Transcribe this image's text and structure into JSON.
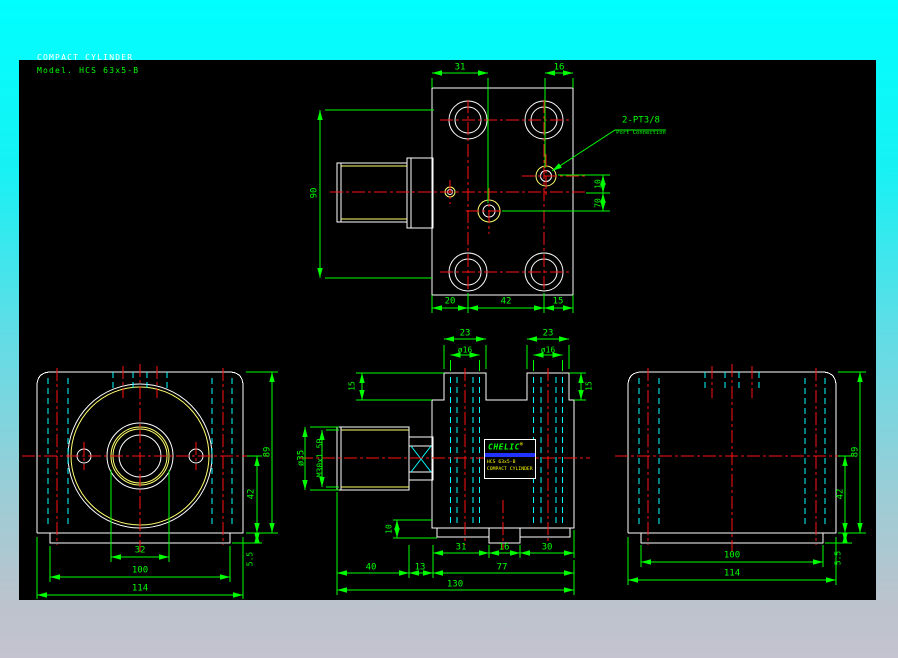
{
  "palette": {
    "background_top": "#00ffff",
    "background_bottom": "#c4c3cf",
    "canvas": "#000000",
    "outline": "#ffffff",
    "dimension": "#00ff00",
    "centerline": "#ff1212",
    "hidden": "#00ffff",
    "thread": "#ffff6e",
    "label_bar": "#2233ff",
    "label_text": "#ffff00"
  },
  "title": {
    "line1": "COMPACT CYLINDER",
    "line2": "Model. HCS 63x5-B"
  },
  "top": {
    "dim_31": "31",
    "dim_16": "16",
    "dim_90": "90",
    "dim_10": "10",
    "dim_70": "70",
    "dim_20": "20",
    "dim_42": "42",
    "dim_15": "15",
    "callout_line1": "2-PT3/8",
    "callout_line2": "Port Connection"
  },
  "front": {
    "dim_32": "32",
    "dim_100": "100",
    "dim_114": "114",
    "dim_89": "89",
    "dim_42": "42",
    "dim_5_5": "5.5"
  },
  "side": {
    "dim_23_left": "23",
    "dim_23_right": "23",
    "dim_d16_left": "ø16",
    "dim_d16_right": "ø16",
    "dim_15_left": "15",
    "dim_15_right": "15",
    "dim_d35": "ø35",
    "dim_thread": "M30x1.5P",
    "dim_10": "10",
    "dim_31": "31",
    "dim_16": "16",
    "dim_30": "30",
    "dim_40": "40",
    "dim_13": "13",
    "dim_77": "77",
    "dim_130": "130",
    "label": {
      "brand": "CHELIC",
      "reg": "®",
      "model": "HCS 63x5-B",
      "product": "COMPACT CYLINDER"
    }
  },
  "back": {
    "dim_100": "100",
    "dim_114": "114",
    "dim_89": "89",
    "dim_42": "42",
    "dim_5_5": "5.5"
  }
}
